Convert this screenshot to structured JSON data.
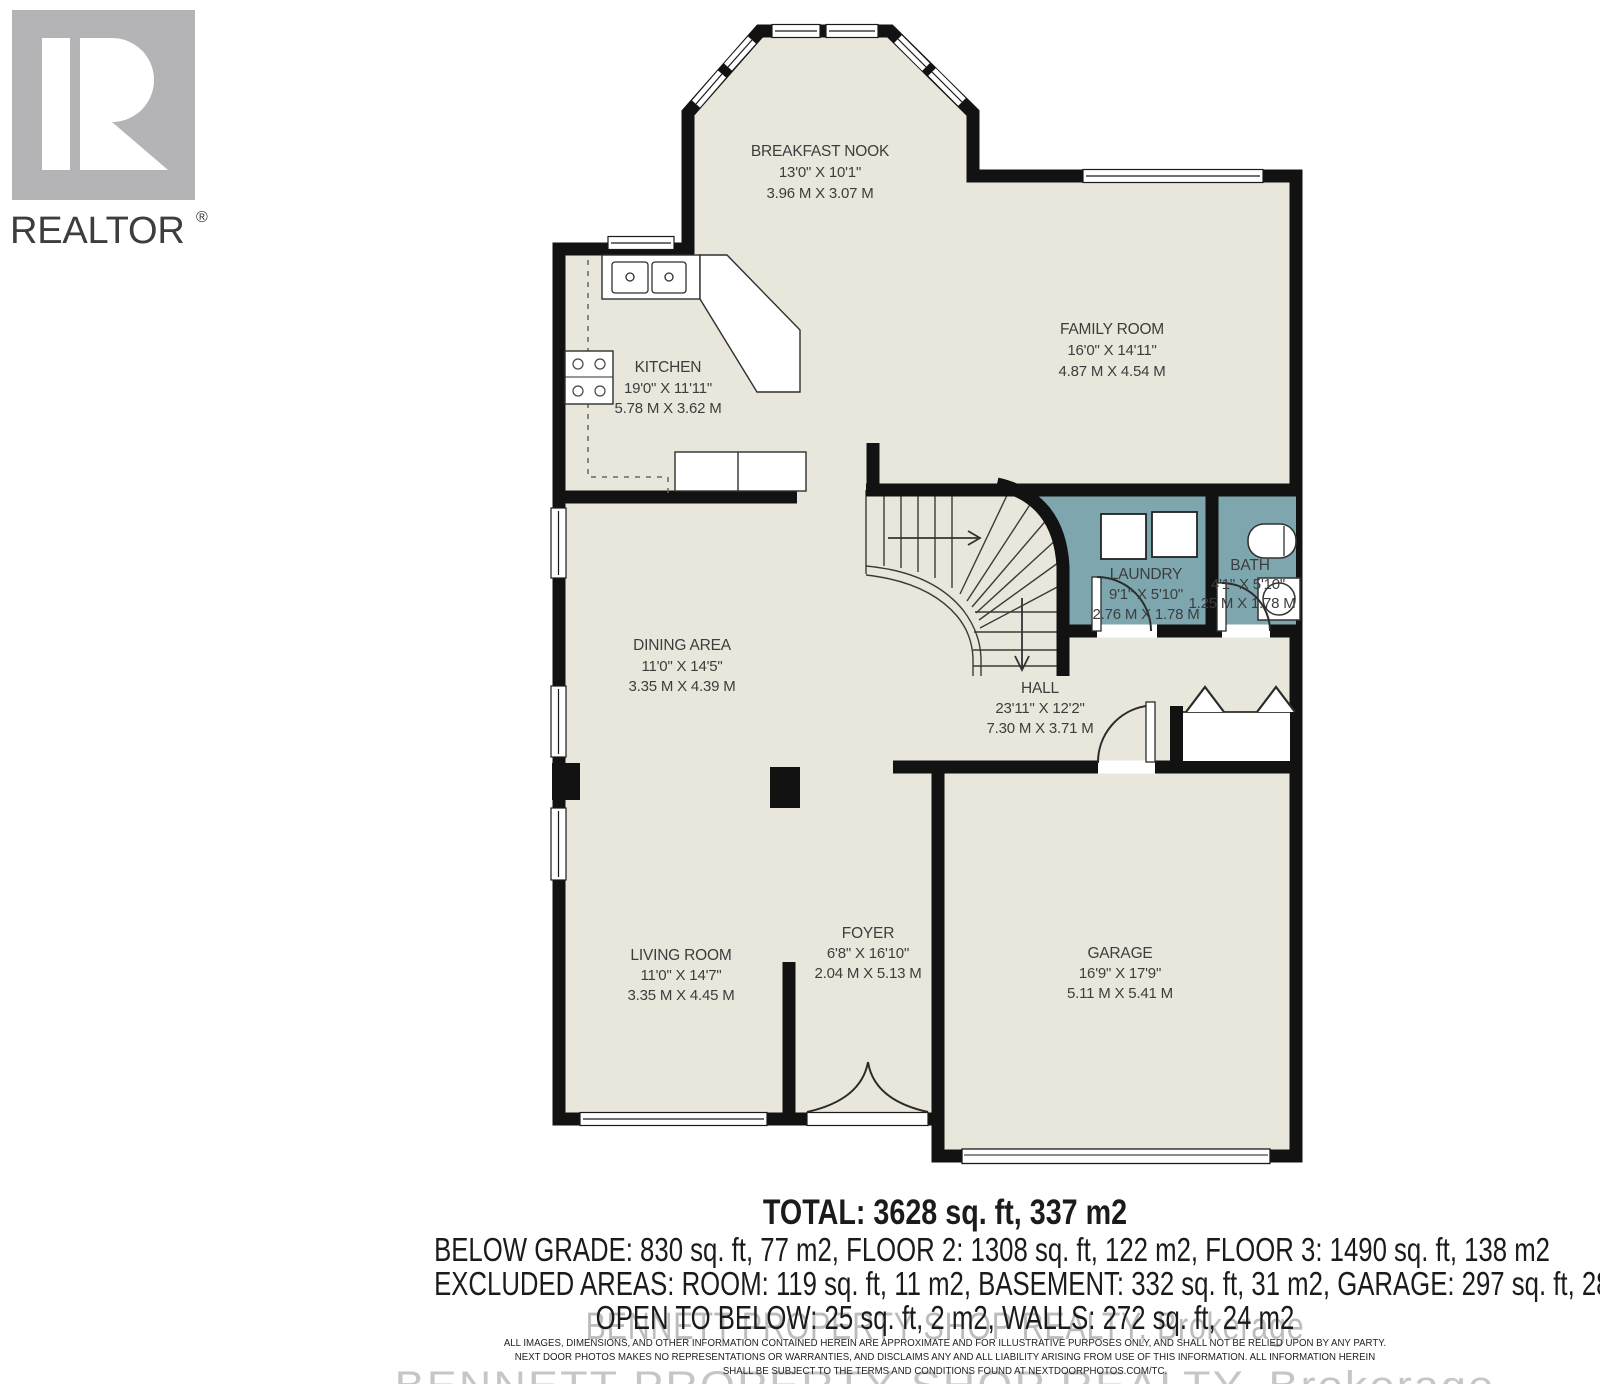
{
  "branding": {
    "realtor_logo_text": "REALTOR",
    "registered_mark": "®",
    "watermark": "BENNETT PROPERTY SHOP REALTY, Brokerage"
  },
  "rooms": {
    "breakfast_nook": {
      "name": "BREAKFAST NOOK",
      "imperial": "13'0\" X 10'1\"",
      "metric": "3.96 M X 3.07 M"
    },
    "family_room": {
      "name": "FAMILY ROOM",
      "imperial": "16'0\" X 14'11\"",
      "metric": "4.87 M X 4.54 M"
    },
    "kitchen": {
      "name": "KITCHEN",
      "imperial": "19'0\" X 11'11\"",
      "metric": "5.78 M X 3.62 M"
    },
    "laundry": {
      "name": "LAUNDRY",
      "imperial": "9'1\" X 5'10\"",
      "metric": "2.76 M X 1.78 M"
    },
    "bath": {
      "name": "BATH",
      "imperial": "4'1\" X 5'10\"",
      "metric": "1.25 M X 1.78 M"
    },
    "dining_area": {
      "name": "DINING AREA",
      "imperial": "11'0\" X 14'5\"",
      "metric": "3.35 M X 4.39 M"
    },
    "hall": {
      "name": "HALL",
      "imperial": "23'11\" X 12'2\"",
      "metric": "7.30 M X 3.71 M"
    },
    "living_room": {
      "name": "LIVING ROOM",
      "imperial": "11'0\" X 14'7\"",
      "metric": "3.35 M X 4.45 M"
    },
    "foyer": {
      "name": "FOYER",
      "imperial": "6'8\" X 16'10\"",
      "metric": "2.04 M X 5.13 M"
    },
    "garage": {
      "name": "GARAGE",
      "imperial": "16'9\" X 17'9\"",
      "metric": "5.11 M X 5.41 M"
    }
  },
  "summary": {
    "total": "TOTAL: 3628 sq. ft, 337 m2",
    "line2": "BELOW GRADE: 830 sq. ft, 77 m2, FLOOR 2: 1308 sq. ft, 122 m2, FLOOR 3: 1490 sq. ft, 138 m2",
    "line3": "EXCLUDED AREAS: ROOM: 119 sq. ft, 11 m2, BASEMENT: 332 sq. ft, 31 m2, GARAGE: 297 sq. ft, 28 m2,",
    "line4": "OPEN TO BELOW: 25 sq. ft, 2 m2, WALLS: 272 sq. ft, 24 m2"
  },
  "disclaimer": {
    "line1": "ALL IMAGES, DIMENSIONS, AND OTHER INFORMATION CONTAINED HEREIN ARE APPROXIMATE AND FOR ILLUSTRATIVE PURPOSES ONLY, AND SHALL NOT BE RELIED UPON BY ANY PARTY.",
    "line2": "NEXT DOOR PHOTOS MAKES NO REPRESENTATIONS OR WARRANTIES, AND DISCLAIMS ANY AND ALL LIABILITY ARISING FROM USE OF THIS INFORMATION. ALL INFORMATION HEREIN",
    "line3": "SHALL BE SUBJECT TO THE TERMS AND CONDITIONS FOUND AT NEXTDOORPHOTOS.COM/TC."
  },
  "colors": {
    "floor_fill": "#e9e7db",
    "wet_room_fill": "#7ea6af",
    "wall": "#121212",
    "label_text": "#3d3d3d",
    "logo_gray": "#b4b3b5"
  }
}
